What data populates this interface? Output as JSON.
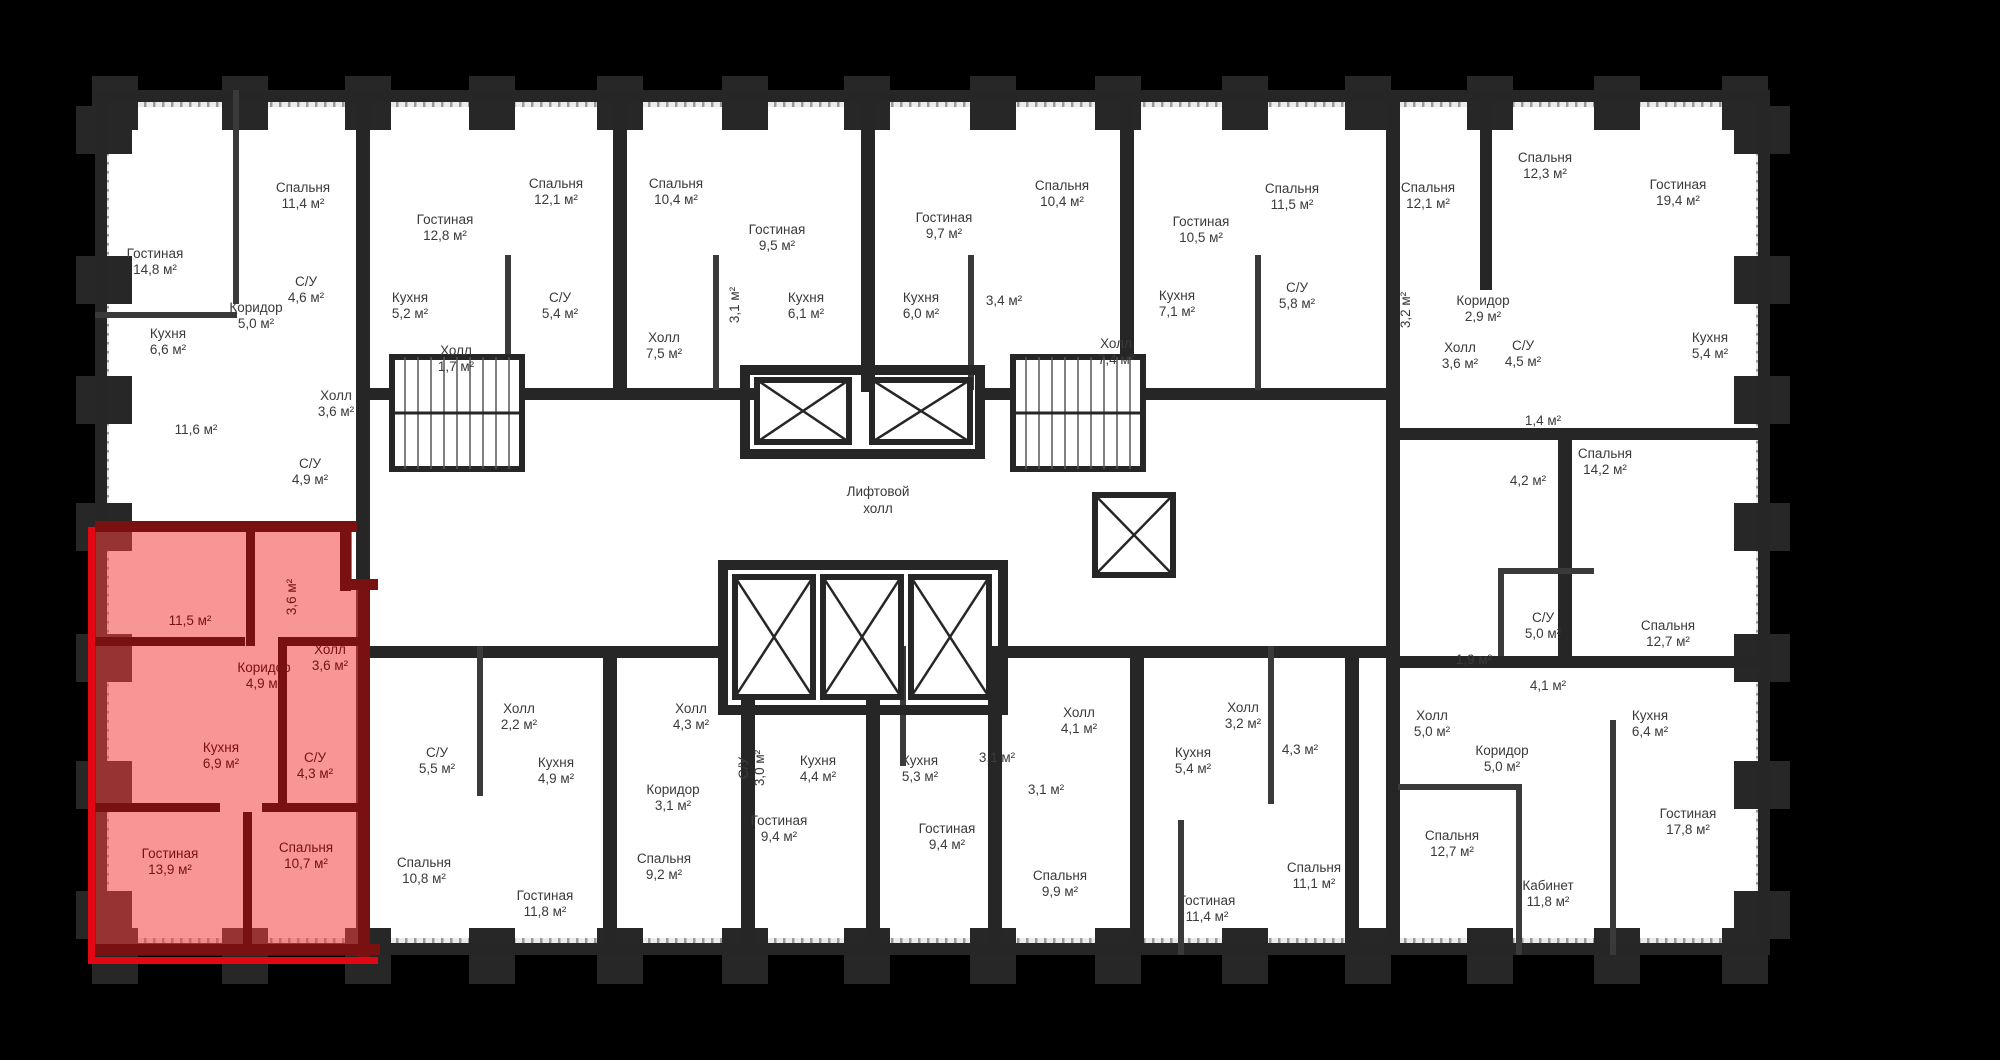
{
  "plan": {
    "colors": {
      "background": "#000000",
      "floor": "#ffffff",
      "wall": "#262626",
      "thin_wall": "#3a3a3a",
      "pillar": "#272727",
      "hatch": "#9a9a9a",
      "label_text": "#3a3a3a",
      "highlight_fill": "rgba(242,62,62,0.55)",
      "highlight_wall": "#7a1111",
      "highlight_edge": "#e30613",
      "highlight_text": "#7a1111"
    },
    "core": {
      "elevator_hall_line1": "Лифтовой",
      "elevator_hall_line2": "холл"
    },
    "units": "м²",
    "rooms": [
      {
        "n": "Гостиная",
        "a": "14,8 м²",
        "x": 155,
        "y": 258
      },
      {
        "n": "Спальня",
        "a": "11,4 м²",
        "x": 303,
        "y": 192
      },
      {
        "n": "Кухня",
        "a": "6,6 м²",
        "x": 168,
        "y": 338
      },
      {
        "n": "Коридор",
        "a": "5,0 м²",
        "x": 256,
        "y": 312
      },
      {
        "n": "С/У",
        "a": "4,6 м²",
        "x": 306,
        "y": 286
      },
      {
        "n": "Холл",
        "a": "3,6 м²",
        "x": 336,
        "y": 400
      },
      {
        "n": "",
        "a": "11,6 м²",
        "x": 196,
        "y": 434
      },
      {
        "n": "С/У",
        "a": "4,9 м²",
        "x": 310,
        "y": 468
      },
      {
        "n": "Гостиная",
        "a": "12,8 м²",
        "x": 445,
        "y": 224
      },
      {
        "n": "Кухня",
        "a": "5,2 м²",
        "x": 410,
        "y": 302
      },
      {
        "n": "Спальня",
        "a": "12,1 м²",
        "x": 556,
        "y": 188
      },
      {
        "n": "С/У",
        "a": "5,4 м²",
        "x": 560,
        "y": 302
      },
      {
        "n": "Холл",
        "a": "1,7 м²",
        "x": 456,
        "y": 355
      },
      {
        "n": "Спальня",
        "a": "10,4 м²",
        "x": 676,
        "y": 188
      },
      {
        "n": "Холл",
        "a": "7,5 м²",
        "x": 664,
        "y": 342
      },
      {
        "n": "",
        "a": "3,1 м²",
        "x": 739,
        "y": 305,
        "v": true
      },
      {
        "n": "Гостиная",
        "a": "9,5 м²",
        "x": 777,
        "y": 234
      },
      {
        "n": "Кухня",
        "a": "6,1 м²",
        "x": 806,
        "y": 302
      },
      {
        "n": "Кухня",
        "a": "6,0 м²",
        "x": 921,
        "y": 302
      },
      {
        "n": "Гостиная",
        "a": "9,7 м²",
        "x": 944,
        "y": 222
      },
      {
        "n": "",
        "a": "3,4 м²",
        "x": 1004,
        "y": 305
      },
      {
        "n": "Спальня",
        "a": "10,4 м²",
        "x": 1062,
        "y": 190
      },
      {
        "n": "Холл",
        "a": "7,4 м²",
        "x": 1116,
        "y": 348
      },
      {
        "n": "Гостиная",
        "a": "10,5 м²",
        "x": 1201,
        "y": 226
      },
      {
        "n": "Кухня",
        "a": "7,1 м²",
        "x": 1177,
        "y": 300
      },
      {
        "n": "Спальня",
        "a": "11,5 м²",
        "x": 1292,
        "y": 193
      },
      {
        "n": "С/У",
        "a": "5,8 м²",
        "x": 1297,
        "y": 292
      },
      {
        "n": "Спальня",
        "a": "12,1 м²",
        "x": 1428,
        "y": 192
      },
      {
        "n": "",
        "a": "3,2 м²",
        "x": 1410,
        "y": 310,
        "v": true
      },
      {
        "n": "Коридор",
        "a": "2,9 м²",
        "x": 1483,
        "y": 305
      },
      {
        "n": "Холл",
        "a": "3,6 м²",
        "x": 1460,
        "y": 352
      },
      {
        "n": "С/У",
        "a": "4,5 м²",
        "x": 1523,
        "y": 350
      },
      {
        "n": "",
        "a": "1,4 м²",
        "x": 1543,
        "y": 425
      },
      {
        "n": "Спальня",
        "a": "12,3 м²",
        "x": 1545,
        "y": 162
      },
      {
        "n": "Гостиная",
        "a": "19,4 м²",
        "x": 1678,
        "y": 189
      },
      {
        "n": "Кухня",
        "a": "5,4 м²",
        "x": 1710,
        "y": 342
      },
      {
        "n": "Спальня",
        "a": "14,2 м²",
        "x": 1605,
        "y": 458
      },
      {
        "n": "",
        "a": "4,2 м²",
        "x": 1528,
        "y": 485
      },
      {
        "n": "С/У",
        "a": "5,0 м²",
        "x": 1543,
        "y": 622
      },
      {
        "n": "Спальня",
        "a": "12,7 м²",
        "x": 1668,
        "y": 630
      },
      {
        "n": "",
        "a": "1,9 м²",
        "x": 1474,
        "y": 664
      },
      {
        "n": "",
        "a": "4,1 м²",
        "x": 1548,
        "y": 690
      },
      {
        "n": "Кухня",
        "a": "6,4 м²",
        "x": 1650,
        "y": 720
      },
      {
        "n": "Холл",
        "a": "5,0 м²",
        "x": 1432,
        "y": 720
      },
      {
        "n": "Коридор",
        "a": "5,0 м²",
        "x": 1502,
        "y": 755
      },
      {
        "n": "Спальня",
        "a": "12,7 м²",
        "x": 1452,
        "y": 840
      },
      {
        "n": "Кабинет",
        "a": "11,8 м²",
        "x": 1548,
        "y": 890
      },
      {
        "n": "Гостиная",
        "a": "17,8 м²",
        "x": 1688,
        "y": 818
      },
      {
        "n": "Холл",
        "a": "4,1 м²",
        "x": 1079,
        "y": 717
      },
      {
        "n": "Холл",
        "a": "3,2 м²",
        "x": 1243,
        "y": 712
      },
      {
        "n": "Кухня",
        "a": "5,4 м²",
        "x": 1193,
        "y": 757
      },
      {
        "n": "",
        "a": "4,3 м²",
        "x": 1300,
        "y": 754
      },
      {
        "n": "Спальня",
        "a": "9,9 м²",
        "x": 1060,
        "y": 880
      },
      {
        "n": "Гостиная",
        "a": "11,4 м²",
        "x": 1207,
        "y": 905
      },
      {
        "n": "Спальня",
        "a": "11,1 м²",
        "x": 1314,
        "y": 872
      },
      {
        "n": "",
        "a": "3,1 м²",
        "x": 1046,
        "y": 794
      },
      {
        "n": "С/У",
        "a": "3,0 м²",
        "x": 748,
        "y": 768,
        "v": true
      },
      {
        "n": "Кухня",
        "a": "4,4 м²",
        "x": 818,
        "y": 765
      },
      {
        "n": "Гостиная",
        "a": "9,4 м²",
        "x": 779,
        "y": 825
      },
      {
        "n": "Кухня",
        "a": "5,3 м²",
        "x": 920,
        "y": 765
      },
      {
        "n": "Гостиная",
        "a": "9,4 м²",
        "x": 947,
        "y": 833
      },
      {
        "n": "",
        "a": "3,1 м²",
        "x": 997,
        "y": 762
      },
      {
        "n": "Коридор",
        "a": "3,1 м²",
        "x": 673,
        "y": 794
      },
      {
        "n": "Холл",
        "a": "4,3 м²",
        "x": 691,
        "y": 713
      },
      {
        "n": "Спальня",
        "a": "9,2 м²",
        "x": 664,
        "y": 863
      },
      {
        "n": "Холл",
        "a": "2,2 м²",
        "x": 519,
        "y": 713
      },
      {
        "n": "Кухня",
        "a": "4,9 м²",
        "x": 556,
        "y": 767
      },
      {
        "n": "С/У",
        "a": "5,5 м²",
        "x": 437,
        "y": 757
      },
      {
        "n": "Спальня",
        "a": "10,8 м²",
        "x": 424,
        "y": 867
      },
      {
        "n": "Гостиная",
        "a": "11,8 м²",
        "x": 545,
        "y": 900
      },
      {
        "n": "",
        "a": "11,5 м²",
        "x": 190,
        "y": 625,
        "h": true
      },
      {
        "n": "",
        "a": "3,6 м²",
        "x": 296,
        "y": 597,
        "v": true,
        "h": true
      },
      {
        "n": "Коридор",
        "a": "4,9 м²",
        "x": 264,
        "y": 672,
        "h": true
      },
      {
        "n": "Холл",
        "a": "3,6 м²",
        "x": 330,
        "y": 654,
        "h": true
      },
      {
        "n": "Кухня",
        "a": "6,9 м²",
        "x": 221,
        "y": 752,
        "h": true
      },
      {
        "n": "С/У",
        "a": "4,3 м²",
        "x": 315,
        "y": 762,
        "h": true
      },
      {
        "n": "Гостиная",
        "a": "13,9 м²",
        "x": 170,
        "y": 858,
        "h": true
      },
      {
        "n": "Спальня",
        "a": "10,7 м²",
        "x": 306,
        "y": 852,
        "h": true
      }
    ]
  }
}
